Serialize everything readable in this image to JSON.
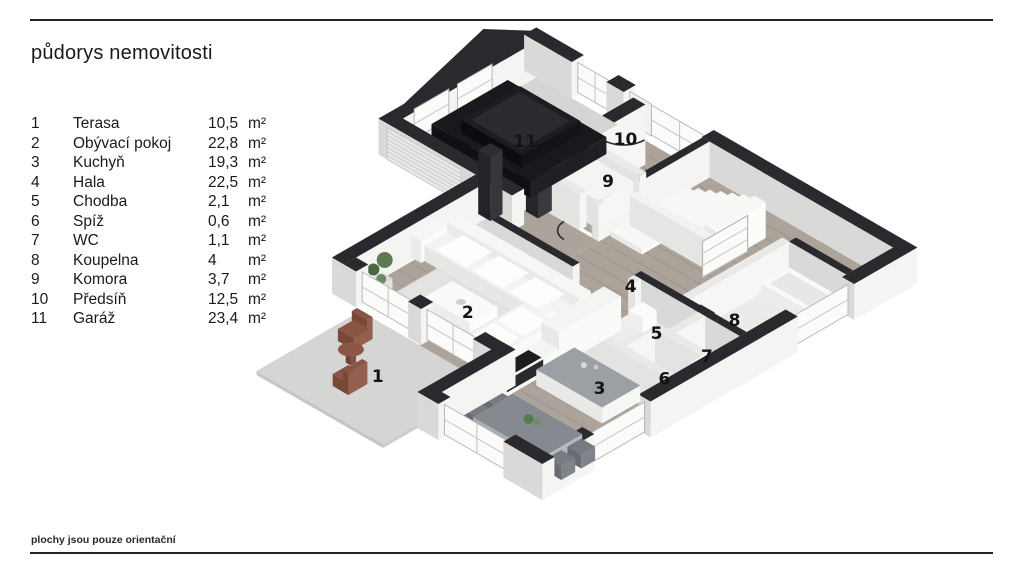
{
  "title": "půdorys nemovitosti",
  "footer": "plochy jsou pouze orientační",
  "legend": {
    "unit": "m²",
    "rows": [
      {
        "num": "1",
        "name": "Terasa",
        "area": "10,5"
      },
      {
        "num": "2",
        "name": "Obývací pokoj",
        "area": "22,8"
      },
      {
        "num": "3",
        "name": "Kuchyň",
        "area": "19,3"
      },
      {
        "num": "4",
        "name": "Hala",
        "area": "22,5"
      },
      {
        "num": "5",
        "name": "Chodba",
        "area": "2,1"
      },
      {
        "num": "6",
        "name": "Spíž",
        "area": "0,6"
      },
      {
        "num": "7",
        "name": "WC",
        "area": "1,1"
      },
      {
        "num": "8",
        "name": "Koupelna",
        "area": "4"
      },
      {
        "num": "9",
        "name": "Komora",
        "area": "3,7"
      },
      {
        "num": "10",
        "name": "Předsíň",
        "area": "12,5"
      },
      {
        "num": "11",
        "name": "Garáž",
        "area": "23,4"
      }
    ]
  },
  "floorplan": {
    "description": "isometric 3D floor plan with numbered rooms and black SUV in garage",
    "room_numbers": [
      "1",
      "2",
      "3",
      "4",
      "5",
      "6",
      "7",
      "8",
      "9",
      "10",
      "11"
    ]
  },
  "colors": {
    "wall_top": "#2a2a2e",
    "wall_face_light": "#f4f4f2",
    "wall_face_shade": "#d9d9d7",
    "wood_floor": "#aca49b",
    "concrete_floor": "#d5d5d3",
    "rug": "#e3e3e1",
    "car_body": "#18181c",
    "terrace_furniture": "#8d5646",
    "text": "#1a1a1a"
  }
}
